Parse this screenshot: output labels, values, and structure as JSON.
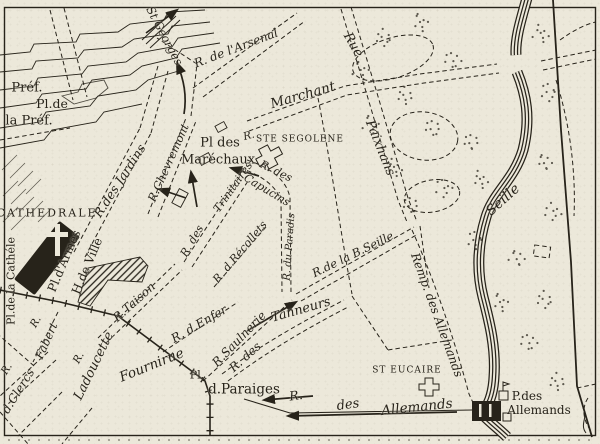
{
  "map": {
    "kind": "engraved-city-plan",
    "colors": {
      "paper": "#ece8da",
      "ink": "#27231a"
    },
    "labels": [
      {
        "id": "pref",
        "text": "Préf.",
        "x": 27,
        "y": 88,
        "r": 0,
        "s": 13,
        "st": "r"
      },
      {
        "id": "pl-de-la-pref-1",
        "text": "Pl.de",
        "x": 52,
        "y": 104,
        "r": 0,
        "s": 12.5,
        "st": "r"
      },
      {
        "id": "pl-de-la-pref-2",
        "text": "la Préf.",
        "x": 29,
        "y": 121,
        "r": 0,
        "s": 13,
        "st": "r"
      },
      {
        "id": "st-georges",
        "text": "St Georges",
        "x": 164,
        "y": 36,
        "r": 62,
        "s": 11.5,
        "st": "i"
      },
      {
        "id": "r-de-l-arsenal",
        "text": "R. de l'Arsenal",
        "x": 236,
        "y": 48,
        "r": -21,
        "s": 12,
        "st": "i"
      },
      {
        "id": "rue-marchant",
        "text": "Marchant",
        "x": 303,
        "y": 96,
        "r": -16,
        "s": 13.5,
        "st": "i"
      },
      {
        "id": "rue-paixhans-1",
        "text": "Rue",
        "x": 353,
        "y": 45,
        "r": 60,
        "s": 13,
        "st": "i"
      },
      {
        "id": "rue-paixhans-2",
        "text": "Paixhans",
        "x": 380,
        "y": 148,
        "r": 68,
        "s": 13,
        "st": "i"
      },
      {
        "id": "pl-des-marechaux-1",
        "text": "Pl des",
        "x": 220,
        "y": 143,
        "r": 0,
        "s": 13,
        "st": "r"
      },
      {
        "id": "pl-des-marechaux-2",
        "text": "Maréchaux",
        "x": 218,
        "y": 160,
        "r": 0,
        "s": 13,
        "st": "r"
      },
      {
        "id": "r-segolene",
        "text": "R.",
        "x": 249,
        "y": 136,
        "r": -15,
        "s": 10.5,
        "st": "i"
      },
      {
        "id": "ste-segolene",
        "text": "STE SEGOLENE",
        "x": 300,
        "y": 140,
        "r": 0,
        "s": 9,
        "st": "c",
        "ls": 1
      },
      {
        "id": "r-des-jardins",
        "text": "R.des Jardins",
        "x": 120,
        "y": 181,
        "r": -57,
        "s": 12.5,
        "st": "i"
      },
      {
        "id": "r-chevremont",
        "text": "R.Chevremont",
        "x": 169,
        "y": 163,
        "r": -66,
        "s": 11.5,
        "st": "i"
      },
      {
        "id": "cathedrale",
        "text": "CATHEDRALE",
        "x": 47,
        "y": 213,
        "r": 0,
        "s": 11,
        "st": "c",
        "ls": 2
      },
      {
        "id": "pl-de-la-cathedrale",
        "text": "Pl.de la Cathéle",
        "x": 11,
        "y": 281,
        "r": -90,
        "s": 11,
        "st": "r"
      },
      {
        "id": "pl-d-armes",
        "text": "Pl.d'Armes",
        "x": 64,
        "y": 261,
        "r": -67,
        "s": 12,
        "st": "r"
      },
      {
        "id": "h-de-ville",
        "text": "H.de Ville",
        "x": 87,
        "y": 266,
        "r": -67,
        "s": 12,
        "st": "r"
      },
      {
        "id": "r-fabert-r",
        "text": "R.",
        "x": 36,
        "y": 322,
        "r": -60,
        "s": 10.5,
        "st": "i"
      },
      {
        "id": "r-fabert",
        "text": "Fabert",
        "x": 47,
        "y": 341,
        "r": -66,
        "s": 11.5,
        "st": "i"
      },
      {
        "id": "r-des-clercs-r",
        "text": "R.",
        "x": 7,
        "y": 369,
        "r": -58,
        "s": 10.5,
        "st": "i"
      },
      {
        "id": "r-des-clercs",
        "text": "d.Clercs",
        "x": 18,
        "y": 391,
        "r": -58,
        "s": 12,
        "st": "i"
      },
      {
        "id": "r-ladoucette-r",
        "text": "R.",
        "x": 79,
        "y": 358,
        "r": -62,
        "s": 10.5,
        "st": "i"
      },
      {
        "id": "r-ladoucette",
        "text": "Ladoucette",
        "x": 94,
        "y": 366,
        "r": -64,
        "s": 13,
        "st": "i"
      },
      {
        "id": "r-taison",
        "text": "R.Taison",
        "x": 134,
        "y": 302,
        "r": -42,
        "s": 12,
        "st": "i"
      },
      {
        "id": "fournirue",
        "text": "Fournirue",
        "x": 152,
        "y": 366,
        "r": -22,
        "s": 13.5,
        "st": "i"
      },
      {
        "id": "r-des-trinitaires-1",
        "text": "R. des",
        "x": 192,
        "y": 241,
        "r": -60,
        "s": 11,
        "st": "i"
      },
      {
        "id": "r-des-trinitaires-2",
        "text": "Trinitaires",
        "x": 233,
        "y": 187,
        "r": -55,
        "s": 11,
        "st": "i"
      },
      {
        "id": "r-des-recollets",
        "text": "R. d.Récollets",
        "x": 240,
        "y": 252,
        "r": -50,
        "s": 11,
        "st": "i"
      },
      {
        "id": "r-des-capucins-1",
        "text": "R. des",
        "x": 276,
        "y": 171,
        "r": 26,
        "s": 11,
        "st": "i"
      },
      {
        "id": "r-des-capucins-2",
        "text": "Capucins",
        "x": 267,
        "y": 190,
        "r": 31,
        "s": 11,
        "st": "i"
      },
      {
        "id": "r-du-paradis",
        "text": "R. du Paradis",
        "x": 290,
        "y": 247,
        "r": -86,
        "s": 10,
        "st": "i"
      },
      {
        "id": "r-d-enfer",
        "text": "R. d.Enfer",
        "x": 199,
        "y": 324,
        "r": -30,
        "s": 12,
        "st": "i"
      },
      {
        "id": "r-saulnerie",
        "text": "R.Saulnerie",
        "x": 239,
        "y": 339,
        "r": -46,
        "s": 12,
        "st": "i"
      },
      {
        "id": "r-des-tanneurs-1",
        "text": "R. des",
        "x": 245,
        "y": 357,
        "r": -42,
        "s": 12,
        "st": "i"
      },
      {
        "id": "r-des-tanneurs-2",
        "text": "Tanneurs",
        "x": 301,
        "y": 310,
        "r": -16,
        "s": 13,
        "st": "i"
      },
      {
        "id": "r-de-la-basse-seille",
        "text": "R.de la B.Seille",
        "x": 353,
        "y": 255,
        "r": -26,
        "s": 11.5,
        "st": "i"
      },
      {
        "id": "rempart-des-allemands",
        "text": "Remp. des Allemands",
        "x": 437,
        "y": 315,
        "r": 70,
        "s": 12,
        "st": "i"
      },
      {
        "id": "st-eucaire",
        "text": "ST EUCAIRE",
        "x": 407,
        "y": 371,
        "r": 0,
        "s": 9,
        "st": "c",
        "ls": 1
      },
      {
        "id": "pl-des-paraiges-1",
        "text": "Pl.",
        "x": 197,
        "y": 375,
        "r": 0,
        "s": 11,
        "st": "r"
      },
      {
        "id": "pl-des-paraiges-2",
        "text": "d.Paraiges",
        "x": 244,
        "y": 390,
        "r": 0,
        "s": 13.5,
        "st": "r"
      },
      {
        "id": "r-des-allemands-r",
        "text": "R.",
        "x": 296,
        "y": 396,
        "r": -8,
        "s": 12.5,
        "st": "i"
      },
      {
        "id": "r-des-allemands-des",
        "text": "des",
        "x": 348,
        "y": 405,
        "r": -8,
        "s": 13,
        "st": "i"
      },
      {
        "id": "r-des-allemands",
        "text": "Allemands",
        "x": 417,
        "y": 408,
        "r": -6,
        "s": 13.5,
        "st": "i"
      },
      {
        "id": "porte-des-allemands-1",
        "text": "P.des",
        "x": 527,
        "y": 396,
        "r": 0,
        "s": 12,
        "st": "r"
      },
      {
        "id": "porte-des-allemands-2",
        "text": "Allemands",
        "x": 539,
        "y": 410,
        "r": 0,
        "s": 12,
        "st": "r"
      },
      {
        "id": "seille-river",
        "text": "Seille",
        "x": 503,
        "y": 200,
        "r": -42,
        "s": 14,
        "st": "i"
      }
    ]
  }
}
